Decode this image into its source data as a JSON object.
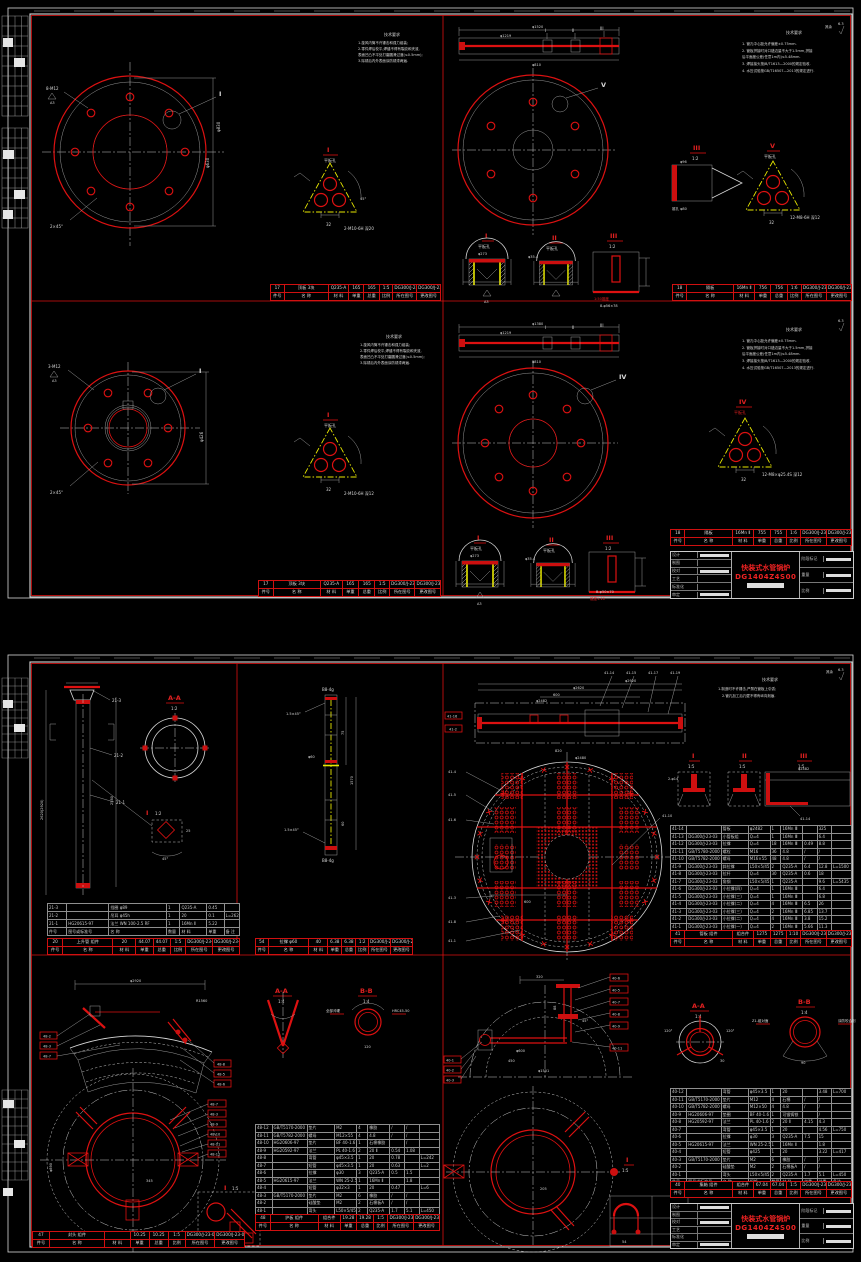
{
  "tb": {
    "product": "快装式水管锅炉",
    "drawing_no": "DG1404Z4S00",
    "rows_left": [
      "设计",
      "制图",
      "校对",
      "工艺",
      "标准化",
      "审定"
    ],
    "cols_right": [
      "阶段标记",
      "重量",
      "比例"
    ]
  },
  "s1": {
    "notes_a": {
      "title": "技术要求",
      "l1": "1.旋风内筒不许锤击和强力组装;",
      "l2": "2.零件焊后校平,焊缝不得有裂纹和夹渣,",
      "l3": "  表面凹凸不平处打磨圆滑过渡(≤0.5mm);",
      "l4": "3.除锈后内外表面涂防锈漆两遍."
    },
    "notes_b": {
      "title": "技术要求",
      "l1": "1. 管孔中心距允许偏差±0.75mm.",
      "l2": "2. 管板拼接时对口错边量不大于1.5mm,拼接",
      "l3": "    后平面度公差(任意1m内)≤5.48mm.",
      "l4": "3. 焊接接头按JB/T1613—2000的规定验收.",
      "l5": "4. 水压试验按GB/T16507—2013的规定进行.",
      "mark": "6.3",
      "rest": "其余"
    },
    "q1": {
      "lead1": "8-M12",
      "flag1": "A3",
      "lead2": "2×45°",
      "ref": "I",
      "dim1": "φ630",
      "dim2": "φ830",
      "det": {
        "ref": "I",
        "sub": "平板孔",
        "note": "2-M10-6H 深20",
        "dim": "32",
        "ang": "45°"
      }
    },
    "q2": {
      "dim_top": "φ1520",
      "dim_mid": "φ1219",
      "dim_bot": "φ810",
      "refs": [
        "I",
        "II",
        "III"
      ],
      "view": "V",
      "d3": {
        "ref": "III",
        "scale": "1:2",
        "dim": "φ96",
        "note": "锥孔 φ80"
      },
      "dv": {
        "ref": "V",
        "sub": "平板孔",
        "note": "12-M8-6H 深12",
        "dim": "32"
      },
      "b1": {
        "ref": "I",
        "sub": "平板孔",
        "dim": "φ273",
        "flag": "A3"
      },
      "b2": {
        "ref": "II",
        "sub": "平板孔",
        "dim": "φ35.4",
        "flag": "A3"
      },
      "b3": {
        "ref": "III",
        "scale": "1:2",
        "note": "1:50锥度",
        "dim": "8-φ56×78"
      }
    },
    "q3": {
      "lead1": "3-M12",
      "flag1": "A3",
      "lead2": "2×45°",
      "ref": "I",
      "dim1": "φ426",
      "det": {
        "ref": "I",
        "sub": "平板孔",
        "note": "2-M10-6H 深12",
        "dim": "32",
        "ang": "45°"
      }
    },
    "q4": {
      "dim_top": "φ1380",
      "dim_mid": "φ1219",
      "dim_bot": "φ810",
      "refs": [
        "I",
        "II",
        "III"
      ],
      "view": "IV",
      "d4": {
        "ref": "IV",
        "sub": "平板孔",
        "note": "12-M8×φ25.4S 深12",
        "dim": "32"
      },
      "b1": {
        "ref": "I",
        "sub": "平板孔",
        "dim": "φ273",
        "flag": "A3"
      },
      "b2": {
        "ref": "II",
        "sub": "平板孔",
        "dim": "φ35.4",
        "flag": "A3"
      },
      "b3": {
        "ref": "III",
        "scale": "1:2",
        "note": "锥度1:10",
        "dim": "B-φ50×70"
      }
    },
    "strips": {
      "q1": [
        [
          "17",
          "顶板  3块",
          "Q235-A",
          "165",
          "165",
          "1:5",
          "DG300/J-23-01",
          "DG300/J-23-02"
        ],
        [
          "件号",
          "名  称",
          "材 料",
          "单重",
          "总重",
          "比例",
          "所在图号",
          "更改图号"
        ]
      ],
      "q2": [
        [
          "18",
          "隔板",
          "16Mn Ⅱ",
          "756",
          "756",
          "1:6",
          "DG300/J-23-01",
          "DG300/J-23-02"
        ],
        [
          "件号",
          "名  称",
          "材 料",
          "单重",
          "总重",
          "比例",
          "所在图号",
          "更改图号"
        ]
      ],
      "q3": [
        [
          "17",
          "顶板  3块",
          "Q235-A",
          "165",
          "165",
          "1:5",
          "DG300/J-23-01",
          "DG300/J-23-02"
        ],
        [
          "件号",
          "名  称",
          "材 料",
          "单重",
          "总重",
          "比例",
          "所在图号",
          "更改图号"
        ]
      ],
      "q4": [
        [
          "18",
          "隔板",
          "16Mn Ⅱ",
          "755",
          "755",
          "1:6",
          "DG300/J-23-01",
          "DG300/J-23-03"
        ],
        [
          "件号",
          "名  称",
          "材 料",
          "单重",
          "总重",
          "比例",
          "所在图号",
          "更改图号"
        ]
      ]
    }
  },
  "s2": {
    "notes": {
      "title": "技术要求",
      "l1": "1.制造时不许锤击,严禁在管板上引弧;",
      "l2": "2.管孔加工后孔壁不得有纵向刻痕.",
      "mark": "6.3",
      "rest": "其余"
    },
    "q1": {
      "dim1": "2620(2920)",
      "dim2": "2580",
      "lab1": "21-3",
      "lab2": "21-2",
      "lab3": "21-1",
      "aa_t": "A-A",
      "aa_s": "1:2",
      "det_t": "I",
      "det_s": "1:2",
      "det_d1": "25",
      "det_d2": "45°",
      "mark_a": "A"
    },
    "q2": {
      "top": "B8-4g",
      "bot": "B8-4g",
      "lead1": "1.5×45°",
      "lead2": "1.5×45°",
      "dim1": "1570",
      "dim2": "75",
      "dim3": "60",
      "dim4": "φ60"
    },
    "q3": {
      "dim1": "φ2920",
      "dim2": "φ2620",
      "dim3": "600",
      "dim4": "φ2482",
      "dim5": "820",
      "dim6": "φ2480",
      "dim7": "600",
      "top_refs": [
        "41-14",
        "41-15",
        "41-17",
        "41-19"
      ],
      "left_ref1": "41-16",
      "left_ref2": "41-2",
      "side_refs": [
        "41-4",
        "41-5",
        "41-6",
        "41-3",
        "41-8",
        "41-1"
      ],
      "r_ref": "41-10",
      "d1_t": "I",
      "d1_s": "1:5",
      "d1_n": "2-φ14",
      "d2_t": "II",
      "d2_s": "1:5",
      "d3_t": "III",
      "d3_s": "1:5",
      "d3_d": "φ2482",
      "d3_r": "41-14"
    },
    "q4": {
      "dim1": "φ2920",
      "dim2": "R1560",
      "dim3": "345",
      "dim4": "φ890",
      "left_refs": [
        "48-2",
        "48-3",
        "48-7"
      ],
      "right_refs": [
        "48-8",
        "48-5",
        "48-6"
      ],
      "col_refs": [
        "48-7",
        "48-3",
        "48-9",
        "48-10",
        "48-11",
        "48-12"
      ],
      "aa_t": "A-A",
      "aa_s": "1:4",
      "bb_t": "B-B",
      "bb_s": "1:4",
      "bb_n1": "全部淬硬",
      "bb_n2": "HRC45-50",
      "bb_d": "120",
      "det_t": "I",
      "det_s": "1:5",
      "det_a": "45°"
    },
    "q5": {
      "dim1": "320",
      "dim2": "450",
      "dim3": "φ1501",
      "dim4": "φ600",
      "dim5": "88",
      "dim6": "45°",
      "dim7": "205",
      "right_refs": [
        "40-6",
        "40-5",
        "40-7",
        "40-8",
        "40-9",
        "40-11"
      ],
      "left_refs": [
        "40-1",
        "40-2",
        "40-3"
      ],
      "aa_t": "A-A",
      "aa_s": "1:4",
      "aa_a1": "120°",
      "aa_a2": "120°",
      "aa_a3": "30",
      "bb_t": "B-B",
      "bb_s": "1:4",
      "bb_n1": "Z1-组对面",
      "bb_n2": "涂防咬合剂",
      "bb_d": "90",
      "ring_ref": "I",
      "ring_s": "1:5",
      "u_d": "54"
    },
    "tables": {
      "q1m": [
        [
          "21-3",
          "",
          "挡圈  φ89",
          "1",
          "Q235-A",
          "0.45",
          ""
        ],
        [
          "21-2",
          "",
          "吊耳  φ45h",
          "1",
          "20",
          "0.1",
          "L=2620"
        ],
        [
          "21-1",
          "HG20615-97",
          "法兰 WN 100-2.5 RF",
          "1",
          "16Mn Ⅱ",
          "5.22",
          ""
        ],
        [
          "件号",
          "图号或标准号",
          "名  称",
          "数量",
          "材 料",
          "单重",
          "备 注"
        ]
      ],
      "q3": [
        [
          "41-14",
          "",
          "管板",
          "φ2482",
          "1",
          "16Mn Ⅲ",
          "",
          "325",
          ""
        ],
        [
          "41-13",
          "DG300/J-23-03",
          "小管板组",
          "Q=4",
          "1",
          "16Mn Ⅲ",
          "",
          "6.4",
          ""
        ],
        [
          "41-12",
          "DG300/J-23-03",
          "拉撑",
          "Q=4",
          "18",
          "16Mn Ⅲ",
          "0.49",
          "8.8",
          ""
        ],
        [
          "41-11",
          "GB/T5780-2000",
          "螺栓",
          "M16",
          "36",
          "4.8",
          "/",
          "/",
          ""
        ],
        [
          "41-10",
          "GB/T5782-2000",
          "螺母",
          "M16×55",
          "48",
          "4.8",
          "/",
          "/",
          ""
        ],
        [
          "41-9",
          "DG300/J-23-03",
          "斜拉撑",
          "L50×5/45",
          "2",
          "Q235-A",
          "6.4",
          "12.8",
          "L=1500"
        ],
        [
          "41-8",
          "DG300/J-23-03",
          "拉杆",
          "Q=4",
          "30",
          "Q235-A",
          "0.6",
          "18",
          ""
        ],
        [
          "41-7",
          "DG300/J-23-03",
          "角钢",
          "L50×5/45",
          "1",
          "Q235-A",
          "",
          "9.6",
          "L=5435"
        ],
        [
          "41-6",
          "DG300/J-23-03",
          "小拉撑(四)",
          "Q=4",
          "1",
          "16Mn Ⅲ",
          "",
          "6.4",
          ""
        ],
        [
          "41-5",
          "DG300/J-23-03",
          "小拉撑(三)",
          "Q=4",
          "1",
          "16Mn Ⅲ",
          "",
          "6.8",
          ""
        ],
        [
          "41-4",
          "DG300/J-23-03",
          "小拉撑(二)",
          "Q=4",
          "4",
          "16Mn Ⅲ",
          "6.5",
          "26",
          ""
        ],
        [
          "41-3",
          "DG300/J-23-03",
          "小拉撑(三)",
          "Q=4",
          "2",
          "16Mn Ⅲ",
          "6.85",
          "13.7",
          ""
        ],
        [
          "41-2",
          "DG300/J-23-03",
          "小拉撑(二)",
          "Q=4",
          "4",
          "16Mn Ⅲ",
          "3.8",
          "15.2",
          ""
        ],
        [
          "41-1",
          "DG300/J-23-03",
          "小拉撑(一)",
          "Q=4",
          "2",
          "16Mn Ⅲ",
          "5.66",
          "11.3",
          ""
        ],
        [
          "件号",
          "图号或标准号",
          "名  称",
          "规格",
          "数量",
          "材 料",
          "单重",
          "总重",
          "备注"
        ]
      ],
      "q4": [
        [
          "48-12",
          "GB/T5170-2000",
          "垫片",
          "M2",
          "4",
          "橡胶",
          "/",
          "/",
          ""
        ],
        [
          "48-11",
          "GB/T5782-2000",
          "螺母",
          "M12×55",
          "4",
          "4.8",
          "/",
          "/",
          ""
        ],
        [
          "48-10",
          "HG20606-97",
          "垫片",
          "BF 40-1.6",
          "1",
          "石棉橡胶",
          "",
          "/",
          ""
        ],
        [
          "48-9",
          "HG20592-97",
          "法兰",
          "PL 40-1.6 RF",
          "2",
          "20 Ⅱ",
          "0.54",
          "1.08",
          ""
        ],
        [
          "48-8",
          "",
          "弯管",
          "φ45×3.5",
          "1",
          "20",
          "0.78",
          "",
          "L=242"
        ],
        [
          "48-7",
          "",
          "短管",
          "φ45×3.5",
          "1",
          "20",
          "0.63",
          "",
          "L=2"
        ],
        [
          "48-6",
          "",
          "拉撑",
          "φ30",
          "3",
          "Q235-A",
          "0.5",
          "1.5",
          ""
        ],
        [
          "48-5",
          "HG20615-97",
          "法兰",
          "WN 25-2.5 RF",
          "1",
          "16Mn Ⅱ",
          "",
          "1.8",
          ""
        ],
        [
          "48-4",
          "",
          "短管",
          "φ32×3",
          "1",
          "20",
          "0.47",
          "",
          "L=6"
        ],
        [
          "48-3",
          "GB/T5170-2000",
          "垫片",
          "M2",
          "6",
          "橡胶",
          "/",
          "/",
          ""
        ],
        [
          "48-2",
          "",
          "硅酸垫",
          "M2",
          "2",
          "石棉板A",
          "/",
          "/",
          ""
        ],
        [
          "48-1",
          "",
          "弯头",
          "L50×5/45",
          "2",
          "Q235-A",
          "1.7",
          "5.1",
          "L=450"
        ],
        [
          "件号",
          "图号或标准号",
          "名  称",
          "规格",
          "数量",
          "材 料",
          "单重",
          "总重",
          "备注"
        ]
      ],
      "q5": [
        [
          "40-12",
          "",
          "弯管",
          "φ45×3.5",
          "1",
          "20",
          "",
          "3.48",
          "L=700"
        ],
        [
          "40-11",
          "GB/T5170-2000",
          "垫片",
          "M12",
          "4",
          "石棉",
          "/",
          "/",
          ""
        ],
        [
          "40-10",
          "GB/T5782-2000",
          "螺母",
          "M12×50",
          "4",
          "4.8",
          "/",
          "/",
          ""
        ],
        [
          "40-9",
          "HG20606-97",
          "垫圈",
          "BF 40-1.6",
          "1",
          "可锻铸铁",
          "",
          "/",
          ""
        ],
        [
          "40-8",
          "HG20592-97",
          "法兰",
          "PL 40-1.6 RF",
          "2",
          "20 Ⅱ",
          "4.15",
          "4.3",
          ""
        ],
        [
          "40-7",
          "",
          "弯管",
          "φ45×3.5",
          "1",
          "20",
          "",
          "4.56",
          "L=750"
        ],
        [
          "40-6",
          "",
          "拉撑",
          "φ30",
          "3",
          "Q235-A",
          "7.5",
          "15",
          ""
        ],
        [
          "40-5",
          "HG20615-97",
          "法兰",
          "WN 25-2.5 RF",
          "1",
          "16Mn Ⅱ",
          "",
          "1.8",
          ""
        ],
        [
          "40-4",
          "",
          "短管",
          "φ425",
          "1",
          "20",
          "",
          "3.22",
          "L=417"
        ],
        [
          "40-3",
          "GB/T5170-2000",
          "垫片",
          "M2",
          "6",
          "橡胶",
          "/",
          "/",
          ""
        ],
        [
          "40-2",
          "",
          "硅酸垫",
          "M2",
          "2",
          "石棉板A",
          "/",
          "/",
          ""
        ],
        [
          "40-1",
          "",
          "弯头",
          "L50×5/45",
          "2",
          "Q235-A",
          "1.7",
          "5.1",
          "L=450"
        ],
        [
          "件号",
          "图号或标准号",
          "名  称",
          "规格",
          "数量",
          "材 料",
          "单重",
          "总重",
          "备注"
        ]
      ]
    },
    "strips": {
      "q1": [
        [
          "20",
          "上升管 组件",
          "20",
          "44.07",
          "44.07",
          "1:5",
          "DG300/J-23-02",
          "DG300/J-23-04"
        ],
        [
          "件号",
          "名  称",
          "材 料",
          "单重",
          "总重",
          "比例",
          "所在图号",
          "更改图号"
        ]
      ],
      "q2": [
        [
          "54",
          "拉撑  φ60",
          "40",
          "6.38",
          "6.38",
          "1:2",
          "DG300/J-23-02",
          "DG300/J-23-05"
        ],
        [
          "件号",
          "名  称",
          "材 料",
          "单重",
          "总重",
          "比例",
          "所在图号",
          "更改图号"
        ]
      ],
      "q3": [
        [
          "41",
          "管板 组件",
          "组合件",
          "1275",
          "1275",
          "1:10",
          "DG300/J-23-02",
          "DG300/J-23-06"
        ],
        [
          "件号",
          "名  称",
          "材 料",
          "单重",
          "总重",
          "比例",
          "所在图号",
          "更改图号"
        ]
      ],
      "q4": [
        [
          "48",
          "护板 组件",
          "组合件",
          "19.28",
          "19.28",
          "1:5",
          "DG300/J-23-02",
          "DG300/J-23-07"
        ],
        [
          "件号",
          "名  称",
          "材 料",
          "单重",
          "总重",
          "比例",
          "所在图号",
          "更改图号"
        ]
      ],
      "q4b": [
        [
          "47",
          "封头 组件",
          "",
          "10.25",
          "10.25",
          "1:5",
          "DG300/J-23-05",
          "DG300/J-23-08"
        ],
        [
          "件号",
          "名  称",
          "材 料",
          "单重",
          "总重",
          "比例",
          "所在图号",
          "更改图号"
        ]
      ],
      "q5": [
        [
          "40",
          "集箱 组件",
          "组合件",
          "67.04",
          "67.04",
          "1:5",
          "DG300/J-23-02",
          "DG300/J-23-09"
        ],
        [
          "件号",
          "名  称",
          "材 料",
          "单重",
          "总重",
          "比例",
          "所在图号",
          "更改图号"
        ]
      ]
    }
  }
}
